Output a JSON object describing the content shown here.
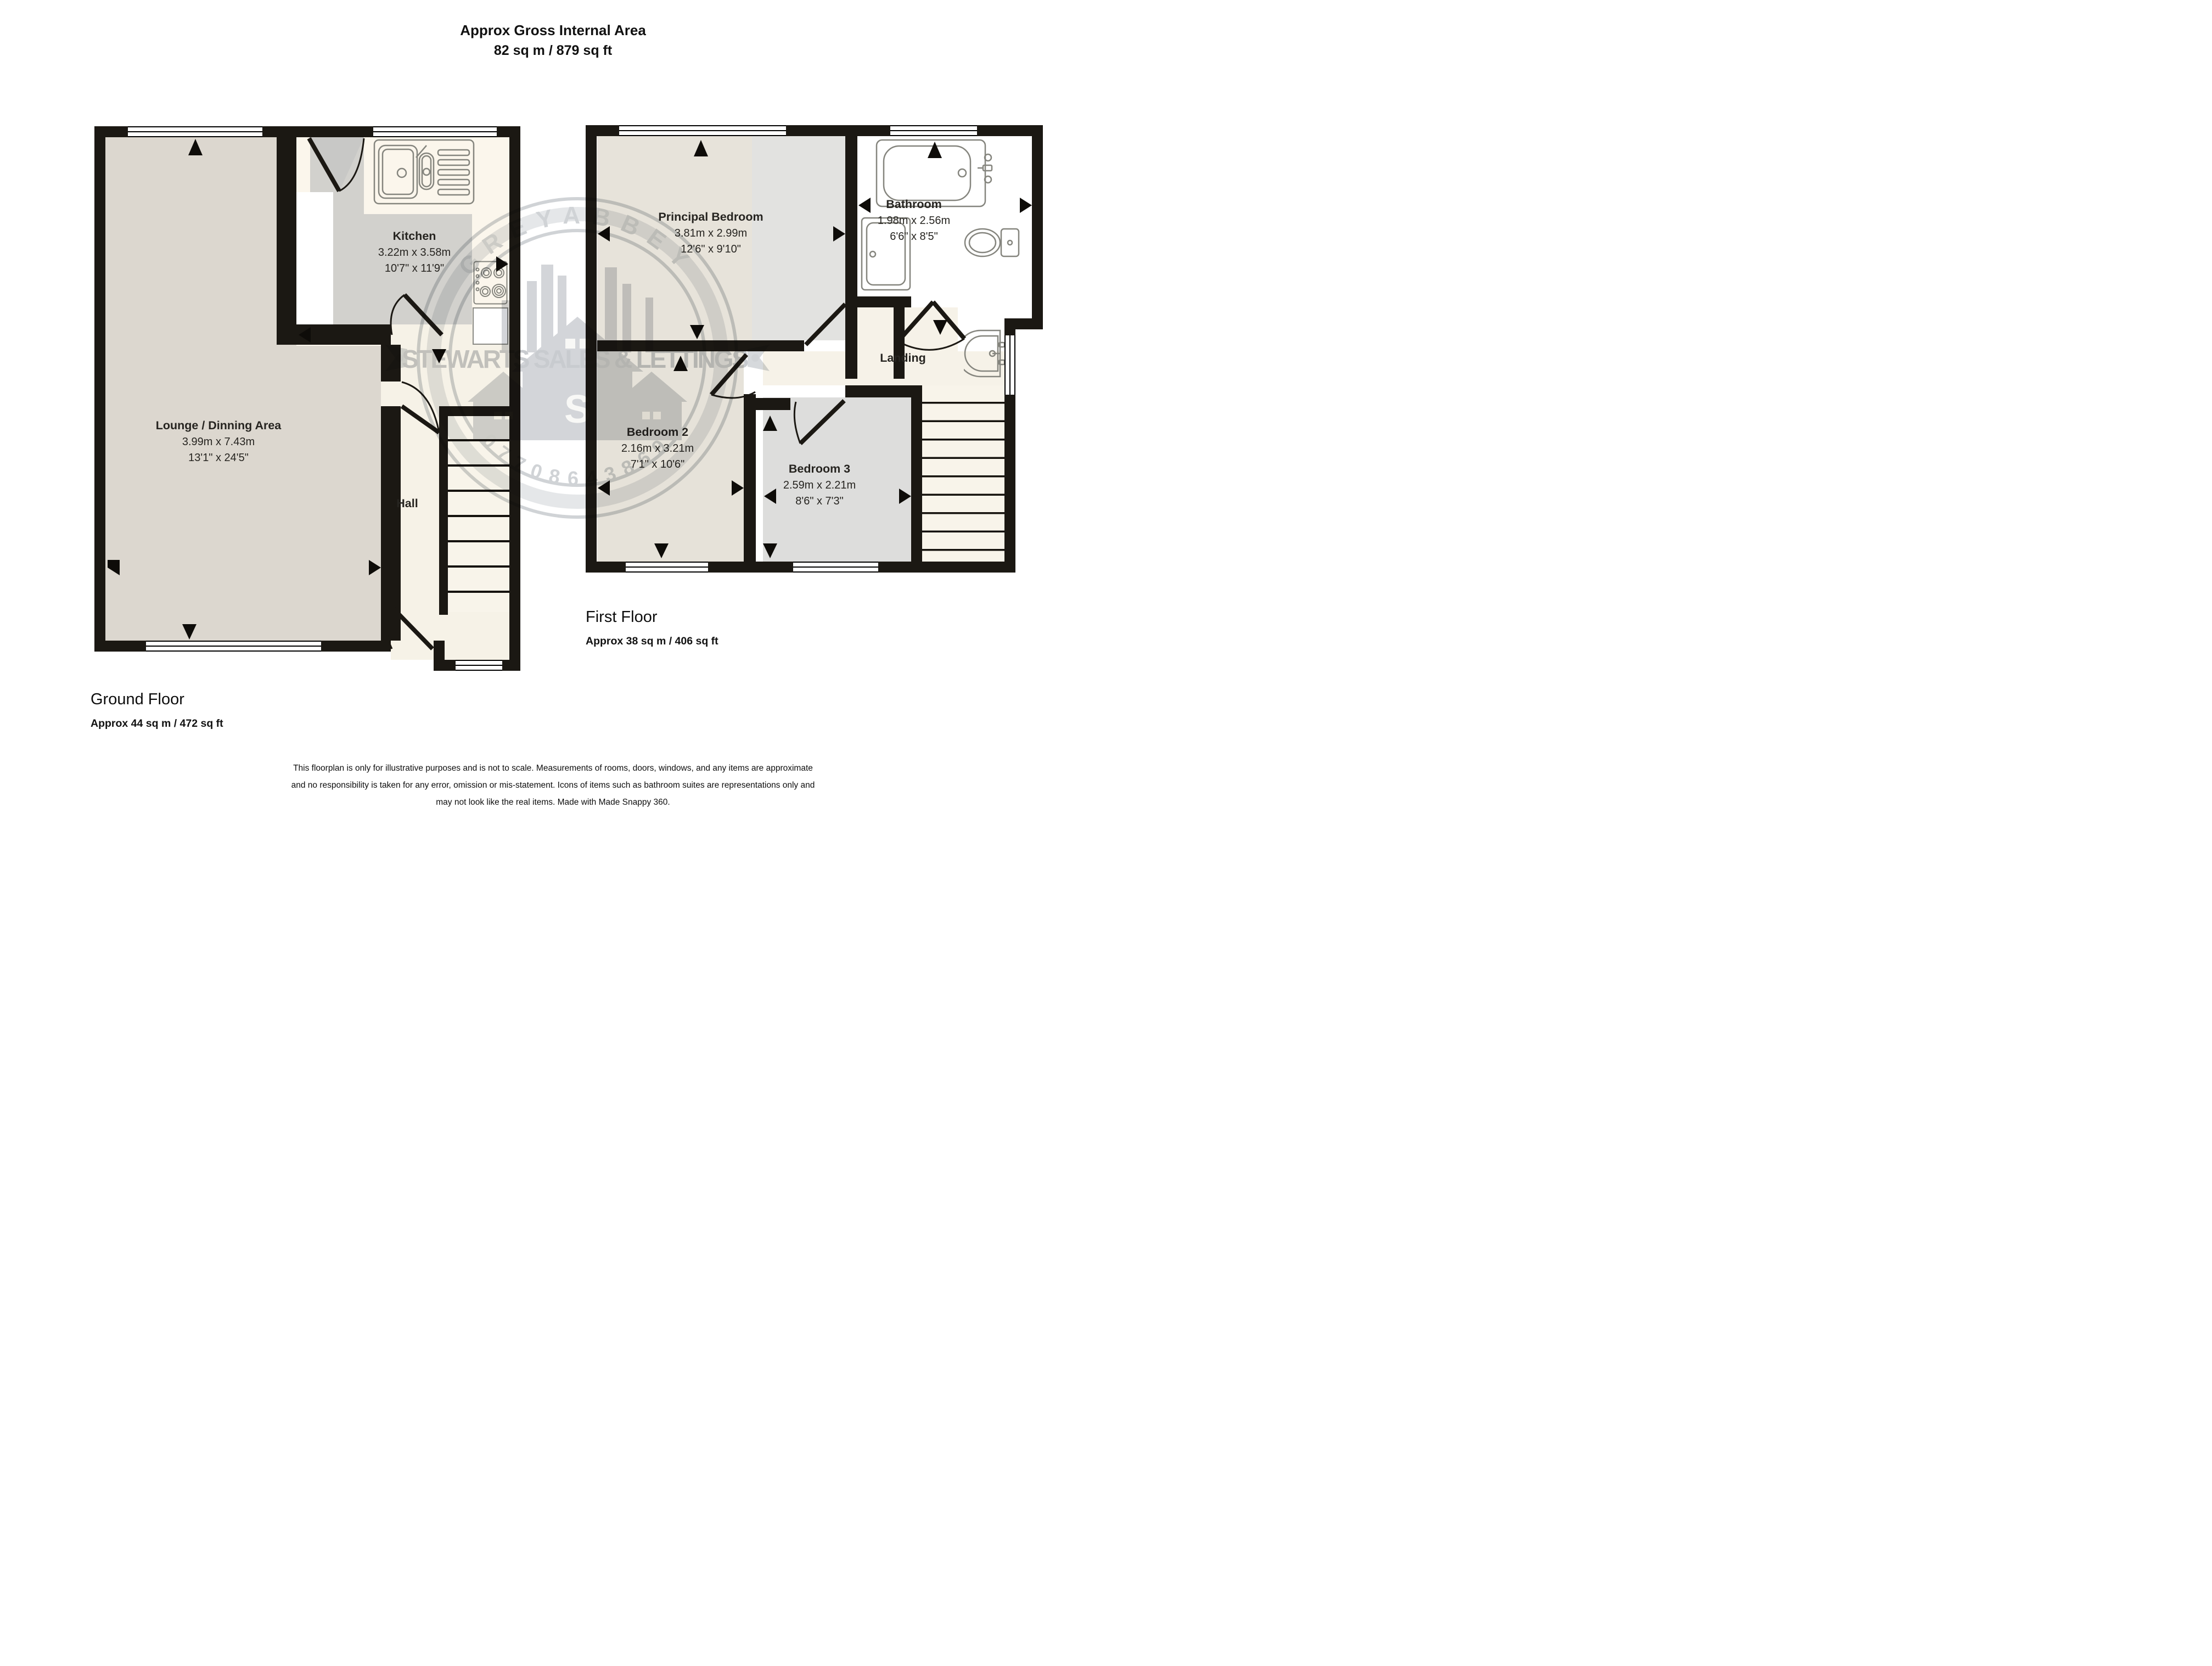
{
  "title": {
    "line1": "Approx Gross Internal Area",
    "line2": "82 sq m / 879 sq ft"
  },
  "ground_floor": {
    "heading": "Ground Floor",
    "area": "Approx 44 sq m / 472 sq ft",
    "rooms": [
      {
        "name": "Kitchen",
        "metric": "3.22m x 3.58m",
        "imperial": "10'7\" x 11'9\""
      },
      {
        "name": "Lounge / Dinning Area",
        "metric": "3.99m x 7.43m",
        "imperial": "13'1\" x 24'5\""
      },
      {
        "name": "Hall"
      }
    ]
  },
  "first_floor": {
    "heading": "First Floor",
    "area": "Approx 38 sq m / 406 sq ft",
    "rooms": [
      {
        "name": "Principal Bedroom",
        "metric": "3.81m x 2.99m",
        "imperial": "12'6\" x 9'10\""
      },
      {
        "name": "Bathroom",
        "metric": "1.98m x 2.56m",
        "imperial": "6'6\" x 8'5\""
      },
      {
        "name": "Landing"
      },
      {
        "name": "Bedroom 2",
        "metric": "2.16m x 3.21m",
        "imperial": "7'1\" x 10'6\""
      },
      {
        "name": "Bedroom 3",
        "metric": "2.59m x 2.21m",
        "imperial": "8'6\" x 7'3\""
      }
    ]
  },
  "watermark": {
    "arc_top": "GREYABBEY",
    "band": "STEWARTS SALES & LETTINGS",
    "arc_bottom": "07708643869",
    "monogram": "S"
  },
  "disclaimer": {
    "line1": "This floorplan is only for illustrative purposes and is not to scale. Measurements of rooms, doors, windows, and any items are approximate",
    "line2": "and no responsibility is taken for any error, omission or mis-statement. Icons of items such as bathroom suites are representations only and",
    "line3": "may not look like the real items. Made with Made Snappy 360."
  },
  "colors": {
    "wall": "#1b1813",
    "lounge_floor": "#dcd7cf",
    "kitchen_floor": "#d2d1cd",
    "counter_cream": "#fbf6ec",
    "hall_cream": "#f6f2e7",
    "bedroom_beige": "#e7e3da",
    "bedroom_grey": "#dddddc",
    "bathroom_white": "#ffffff",
    "watermark_grey": "#9aa0a7"
  }
}
